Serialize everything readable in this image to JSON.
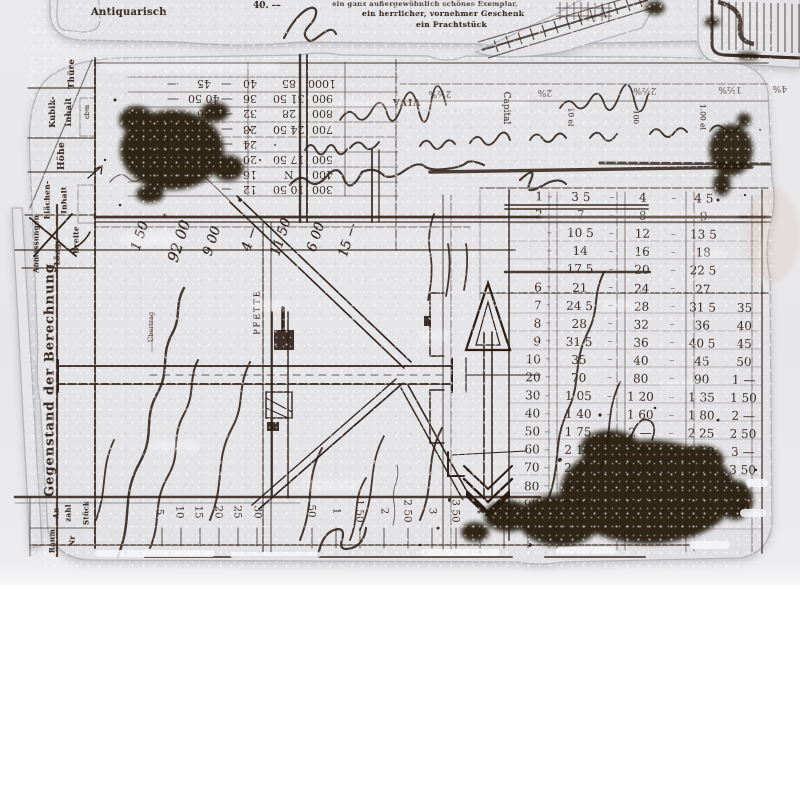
{
  "colors": {
    "photo_bg": "#e9e9eb",
    "page_bg": "#ffffff",
    "ink": "#3a2a22",
    "ink_dark": "#241710",
    "blot": "#281a0f",
    "sheet": "#e4e4e7"
  },
  "top_strip": {
    "antiquarisch": "Antiquarisch",
    "price": "40. —",
    "line1": "ein ganz außergewöhnlich schönes Exemplar,",
    "line2": "ein herrlicher, vornehmer Geschenk",
    "line3": "ein Prachtstück"
  },
  "left_panel": {
    "thuere": "Thüre",
    "kubik1": "Kubik-",
    "kubik2": "Inhalt",
    "cbm": "cbm",
    "hoehe": "Höhe",
    "flaech1": "Flächen-",
    "flaech2": "Inhalt",
    "abmess": "Abmessungen",
    "laenge": "Länge",
    "breite": "Breite",
    "title": "Gegenstand der Berechnung",
    "an": "An",
    "zahl": "zahl",
    "stueck": "Stück",
    "raum": "Raum",
    "nr": "Nr",
    "uebertrag": "Übertrag"
  },
  "upper_table": {
    "col_a": [
      "1000",
      "900",
      "800",
      "700",
      "",
      "500",
      "400",
      "300"
    ],
    "col_b": [
      "85",
      "31 50",
      "28",
      "24 50",
      "",
      "17 50",
      "N",
      "10 50"
    ],
    "col_c": [
      "40",
      "36",
      "32",
      "28",
      "24",
      "20",
      "16",
      "12"
    ],
    "col_d": [
      "45",
      "40 50",
      "36"
    ],
    "viva": "VIVA",
    "capital": "Capital",
    "unit_cols": [
      "10 el",
      "100",
      "1.00 el"
    ],
    "percents": [
      "2½%",
      "2%",
      "2½%",
      "1½%",
      "4%"
    ]
  },
  "drawing": {
    "pfette": "PFETTE"
  },
  "amounts": [
    "1 50",
    "92 00",
    "9 00",
    "4 —",
    "11 50",
    "6 00",
    "15 —"
  ],
  "reckoner": {
    "dash": "–",
    "rows": [
      {
        "i": "1",
        "c1": "3 5",
        "c2": "4",
        "c3": "4 5",
        "c4": ""
      },
      {
        "i": "2",
        "c1": "7",
        "c2": "8",
        "c3": "9",
        "c4": ""
      },
      {
        "i": "",
        "c1": "10 5",
        "c2": "12",
        "c3": "13 5",
        "c4": ""
      },
      {
        "i": "",
        "c1": "14",
        "c2": "16",
        "c3": "18",
        "c4": ""
      },
      {
        "i": "",
        "c1": "17 5",
        "c2": "20",
        "c3": "22 5",
        "c4": ""
      },
      {
        "i": "6",
        "c1": "21",
        "c2": "24",
        "c3": "27",
        "c4": ""
      },
      {
        "i": "7",
        "c1": "24 5",
        "c2": "28",
        "c3": "31 5",
        "c4": "35"
      },
      {
        "i": "8",
        "c1": "28",
        "c2": "32",
        "c3": "36",
        "c4": "40"
      },
      {
        "i": "9",
        "c1": "31 5",
        "c2": "36",
        "c3": "40 5",
        "c4": "45"
      },
      {
        "i": "10",
        "c1": "35",
        "c2": "40",
        "c3": "45",
        "c4": "50"
      },
      {
        "i": "20",
        "c1": "70",
        "c2": "80",
        "c3": "90",
        "c4": "1 —"
      },
      {
        "i": "30",
        "c1": "1 05",
        "c2": "1 20",
        "c3": "1 35",
        "c4": "1 50"
      },
      {
        "i": "40",
        "c1": "1 40",
        "c2": "1 60",
        "c3": "1 80",
        "c4": "2 —"
      },
      {
        "i": "50",
        "c1": "1 75",
        "c2": "2 —",
        "c3": "2 25",
        "c4": "2 50"
      },
      {
        "i": "60",
        "c1": "2 10",
        "c2": "2 40",
        "c3": "2 70",
        "c4": "3 —"
      },
      {
        "i": "70",
        "c1": "2 45",
        "c2": "2 80",
        "c3": "3 15",
        "c4": "3 50"
      },
      {
        "i": "80",
        "c1": "2 80",
        "c2": "3 20",
        "c3": "",
        "c4": ""
      },
      {
        "i": "90",
        "c1": "3 15",
        "c2": "",
        "c3": "",
        "c4": "50"
      }
    ]
  },
  "scales": {
    "small": [
      "5",
      "10",
      "15",
      "20",
      "25",
      "30"
    ],
    "large": [
      "50",
      "1",
      "1 50",
      "2",
      "2 50",
      "3",
      "3 50",
      "4",
      "4 50",
      "5"
    ]
  }
}
